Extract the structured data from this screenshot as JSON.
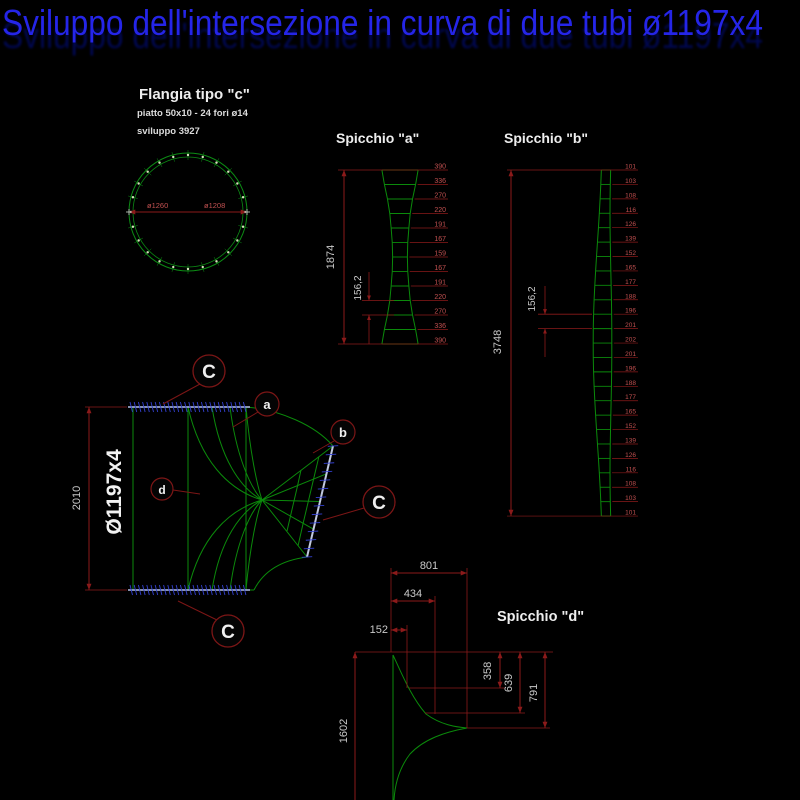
{
  "title": {
    "text": "Sviluppo dell'intersezione in curva di due tubi ø1197x4",
    "color": "#2525e8",
    "echo_color": "#000a66"
  },
  "colors": {
    "background": "#000000",
    "geometry_green": "#0b8a0b",
    "dimension_red": "#8b1a1a",
    "number_red": "#c05050",
    "text_gray": "#c9c9c9",
    "text_white": "#ededed",
    "flange_hatch_blue": "#3340d0",
    "flange_line": "#9aa6c8"
  },
  "flangia": {
    "title": "Flangia tipo \"c\"",
    "subtitle": "piatto 50x10 - 24 fori ø14",
    "sviluppo": "sviluppo 3927",
    "dim_outer": "ø1260",
    "dim_inner": "ø1208",
    "holes_count": 24
  },
  "spicchio_a": {
    "title": "Spicchio \"a\"",
    "height_label": "1874",
    "segment_label": "156,2",
    "widths": [
      390,
      336,
      270,
      220,
      191,
      167,
      159,
      167,
      191,
      220,
      270,
      336,
      390
    ]
  },
  "spicchio_b": {
    "title": "Spicchio \"b\"",
    "height_label": "3748",
    "segment_label": "156,2",
    "widths": [
      101,
      103,
      108,
      116,
      126,
      139,
      152,
      165,
      177,
      188,
      196,
      201,
      202,
      201,
      196,
      188,
      177,
      165,
      152,
      139,
      126,
      116,
      108,
      103,
      101
    ]
  },
  "main_view": {
    "diameter_label": "Ø1197x4",
    "height_label": "2010",
    "balloons": {
      "top_c": "C",
      "a": "a",
      "b": "b",
      "right_c": "C",
      "bottom_c": "C",
      "d": "d"
    }
  },
  "spicchio_d": {
    "title": "Spicchio \"d\"",
    "width_total": "801",
    "width_mid": "434",
    "width_small": "152",
    "drop_1": "358",
    "drop_2": "639",
    "drop_3": "791",
    "height": "1602"
  }
}
